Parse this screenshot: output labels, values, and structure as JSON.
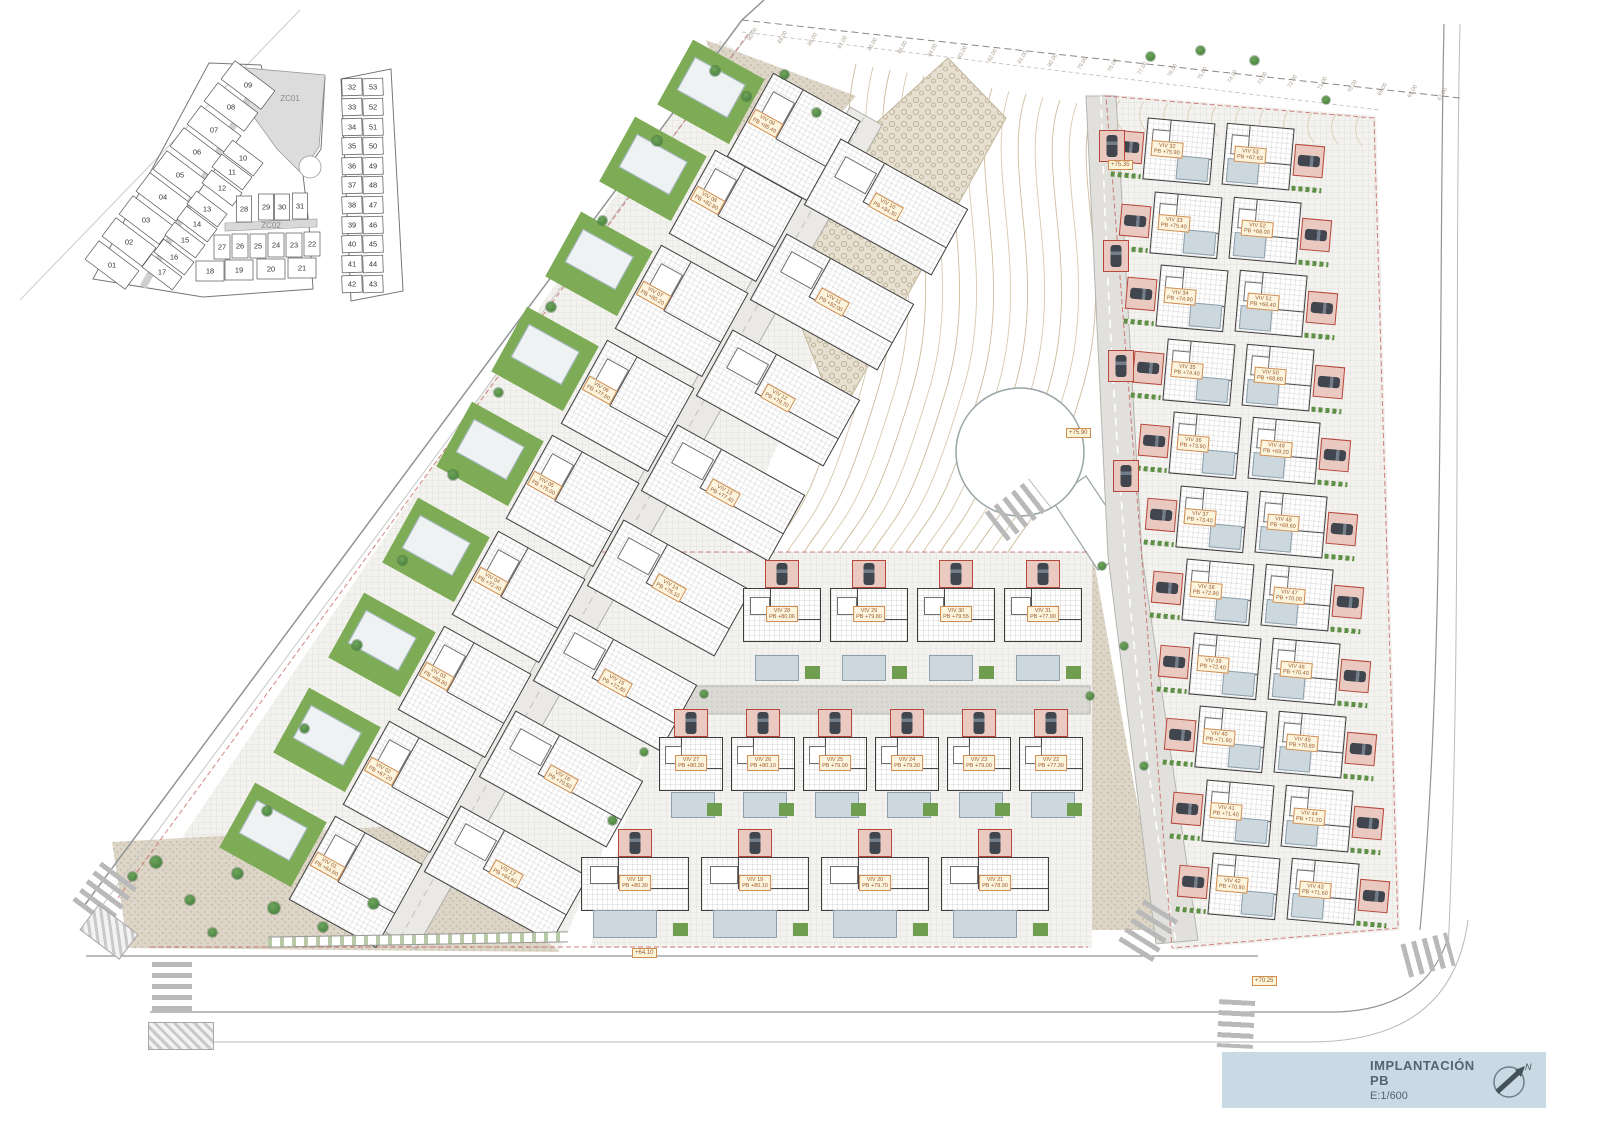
{
  "page": {
    "title_block": {
      "title": "IMPLANTACIÓN PB",
      "scale": "E:1/600",
      "north_label": "N"
    }
  },
  "key_plan": {
    "zones": [
      {
        "label": "ZC01",
        "x": 205,
        "y": 46
      },
      {
        "label": "ZC02",
        "x": 186,
        "y": 173
      }
    ],
    "cells": [
      {
        "n": "01",
        "x": 27,
        "y": 210,
        "w": 50,
        "h": 23,
        "r": 37
      },
      {
        "n": "02",
        "x": 44,
        "y": 187,
        "w": 50,
        "h": 23,
        "r": 37
      },
      {
        "n": "03",
        "x": 61,
        "y": 165,
        "w": 50,
        "h": 23,
        "r": 37
      },
      {
        "n": "04",
        "x": 78,
        "y": 142,
        "w": 50,
        "h": 23,
        "r": 37
      },
      {
        "n": "05",
        "x": 95,
        "y": 120,
        "w": 50,
        "h": 23,
        "r": 37
      },
      {
        "n": "06",
        "x": 112,
        "y": 97,
        "w": 50,
        "h": 23,
        "r": 37
      },
      {
        "n": "07",
        "x": 129,
        "y": 75,
        "w": 50,
        "h": 23,
        "r": 37
      },
      {
        "n": "08",
        "x": 146,
        "y": 52,
        "w": 50,
        "h": 23,
        "r": 37
      },
      {
        "n": "09",
        "x": 163,
        "y": 30,
        "w": 50,
        "h": 23,
        "r": 37
      },
      {
        "n": "10",
        "x": 158,
        "y": 103,
        "w": 38,
        "h": 16,
        "r": 37
      },
      {
        "n": "11",
        "x": 147,
        "y": 117,
        "w": 38,
        "h": 16,
        "r": 37
      },
      {
        "n": "12",
        "x": 137,
        "y": 133,
        "w": 38,
        "h": 16,
        "r": 37
      },
      {
        "n": "13",
        "x": 122,
        "y": 154,
        "w": 38,
        "h": 16,
        "r": 37
      },
      {
        "n": "14",
        "x": 112,
        "y": 169,
        "w": 38,
        "h": 16,
        "r": 37
      },
      {
        "n": "15",
        "x": 100,
        "y": 185,
        "w": 38,
        "h": 16,
        "r": 37
      },
      {
        "n": "16",
        "x": 89,
        "y": 202,
        "w": 38,
        "h": 16,
        "r": 37
      },
      {
        "n": "17",
        "x": 77,
        "y": 217,
        "w": 38,
        "h": 16,
        "r": 37
      },
      {
        "n": "28",
        "x": 159,
        "y": 154,
        "w": 15,
        "h": 26,
        "r": 0
      },
      {
        "n": "29",
        "x": 181,
        "y": 152,
        "w": 15,
        "h": 26,
        "r": 0
      },
      {
        "n": "30",
        "x": 197,
        "y": 152,
        "w": 15,
        "h": 26,
        "r": 0
      },
      {
        "n": "31",
        "x": 215,
        "y": 151,
        "w": 15,
        "h": 26,
        "r": 0
      },
      {
        "n": "27",
        "x": 137,
        "y": 192,
        "w": 16,
        "h": 24,
        "r": 0
      },
      {
        "n": "26",
        "x": 155,
        "y": 191,
        "w": 16,
        "h": 24,
        "r": 0
      },
      {
        "n": "25",
        "x": 173,
        "y": 191,
        "w": 16,
        "h": 24,
        "r": 0
      },
      {
        "n": "24",
        "x": 191,
        "y": 190,
        "w": 16,
        "h": 24,
        "r": 0
      },
      {
        "n": "23",
        "x": 209,
        "y": 190,
        "w": 16,
        "h": 24,
        "r": 0
      },
      {
        "n": "22",
        "x": 227,
        "y": 189,
        "w": 16,
        "h": 24,
        "r": 0
      },
      {
        "n": "18",
        "x": 125,
        "y": 216,
        "w": 28,
        "h": 20,
        "r": 0
      },
      {
        "n": "19",
        "x": 154,
        "y": 215,
        "w": 28,
        "h": 20,
        "r": 0
      },
      {
        "n": "20",
        "x": 186,
        "y": 214,
        "w": 28,
        "h": 20,
        "r": 0
      },
      {
        "n": "21",
        "x": 217,
        "y": 213,
        "w": 28,
        "h": 20,
        "r": 0
      },
      {
        "n": "32",
        "x": 267,
        "y": 32,
        "w": 20,
        "h": 17,
        "r": -2
      },
      {
        "n": "53",
        "x": 288,
        "y": 32,
        "w": 20,
        "h": 17,
        "r": -2
      },
      {
        "n": "33",
        "x": 267,
        "y": 52,
        "w": 20,
        "h": 17,
        "r": -2
      },
      {
        "n": "52",
        "x": 288,
        "y": 52,
        "w": 20,
        "h": 17,
        "r": -2
      },
      {
        "n": "34",
        "x": 267,
        "y": 72,
        "w": 20,
        "h": 17,
        "r": -2
      },
      {
        "n": "51",
        "x": 288,
        "y": 72,
        "w": 20,
        "h": 17,
        "r": -2
      },
      {
        "n": "35",
        "x": 267,
        "y": 91,
        "w": 20,
        "h": 17,
        "r": -2
      },
      {
        "n": "50",
        "x": 288,
        "y": 91,
        "w": 20,
        "h": 17,
        "r": -2
      },
      {
        "n": "36",
        "x": 267,
        "y": 111,
        "w": 20,
        "h": 17,
        "r": -2
      },
      {
        "n": "49",
        "x": 288,
        "y": 111,
        "w": 20,
        "h": 17,
        "r": -2
      },
      {
        "n": "37",
        "x": 267,
        "y": 130,
        "w": 20,
        "h": 17,
        "r": -2
      },
      {
        "n": "48",
        "x": 288,
        "y": 130,
        "w": 20,
        "h": 17,
        "r": -2
      },
      {
        "n": "38",
        "x": 267,
        "y": 150,
        "w": 20,
        "h": 17,
        "r": -2
      },
      {
        "n": "47",
        "x": 288,
        "y": 150,
        "w": 20,
        "h": 17,
        "r": -2
      },
      {
        "n": "39",
        "x": 267,
        "y": 170,
        "w": 20,
        "h": 17,
        "r": -2
      },
      {
        "n": "46",
        "x": 288,
        "y": 170,
        "w": 20,
        "h": 17,
        "r": -2
      },
      {
        "n": "40",
        "x": 267,
        "y": 189,
        "w": 20,
        "h": 17,
        "r": -2
      },
      {
        "n": "45",
        "x": 288,
        "y": 189,
        "w": 20,
        "h": 17,
        "r": -2
      },
      {
        "n": "41",
        "x": 267,
        "y": 209,
        "w": 20,
        "h": 17,
        "r": -2
      },
      {
        "n": "44",
        "x": 288,
        "y": 209,
        "w": 20,
        "h": 17,
        "r": -2
      },
      {
        "n": "42",
        "x": 267,
        "y": 229,
        "w": 20,
        "h": 17,
        "r": -2
      },
      {
        "n": "43",
        "x": 288,
        "y": 229,
        "w": 20,
        "h": 17,
        "r": -2
      }
    ]
  },
  "site": {
    "contour_ticks": [
      {
        "t": "90.00",
        "x": 752,
        "y": 36
      },
      {
        "t": "89.00",
        "x": 782,
        "y": 39
      },
      {
        "t": "88.00",
        "x": 812,
        "y": 41
      },
      {
        "t": "87.00",
        "x": 842,
        "y": 44
      },
      {
        "t": "86.00",
        "x": 872,
        "y": 46
      },
      {
        "t": "85.00",
        "x": 902,
        "y": 49
      },
      {
        "t": "84.00",
        "x": 932,
        "y": 52
      },
      {
        "t": "83.00",
        "x": 962,
        "y": 54
      },
      {
        "t": "82.00",
        "x": 992,
        "y": 57
      },
      {
        "t": "81.00",
        "x": 1022,
        "y": 59
      },
      {
        "t": "80.00",
        "x": 1052,
        "y": 62
      },
      {
        "t": "79.00",
        "x": 1082,
        "y": 65
      },
      {
        "t": "78.00",
        "x": 1112,
        "y": 67
      },
      {
        "t": "77.00",
        "x": 1142,
        "y": 70
      },
      {
        "t": "76.00",
        "x": 1172,
        "y": 72
      },
      {
        "t": "75.00",
        "x": 1202,
        "y": 75
      },
      {
        "t": "74.00",
        "x": 1232,
        "y": 78
      },
      {
        "t": "73.00",
        "x": 1262,
        "y": 80
      },
      {
        "t": "72.00",
        "x": 1292,
        "y": 83
      },
      {
        "t": "71.00",
        "x": 1322,
        "y": 85
      },
      {
        "t": "70.00",
        "x": 1352,
        "y": 88
      },
      {
        "t": "69.00",
        "x": 1382,
        "y": 91
      },
      {
        "t": "68.00",
        "x": 1412,
        "y": 93
      },
      {
        "t": "67.00",
        "x": 1442,
        "y": 96
      }
    ],
    "road_markers": [
      {
        "t": "+75.35",
        "x": 1108,
        "y": 160
      },
      {
        "t": "+75.90",
        "x": 1066,
        "y": 428
      },
      {
        "t": "+64.10",
        "x": 632,
        "y": 948
      },
      {
        "t": "+70.25",
        "x": 1252,
        "y": 976
      }
    ],
    "villas": [
      {
        "n": "VIV 01",
        "pb": "PB +64.60",
        "x": 318,
        "y": 861,
        "t": "west"
      },
      {
        "n": "VIV 02",
        "pb": "PB +67.20",
        "x": 372,
        "y": 766,
        "t": "west"
      },
      {
        "n": "VIV 03",
        "pb": "PB +69.80",
        "x": 427,
        "y": 671,
        "t": "west"
      },
      {
        "n": "VIV 04",
        "pb": "PB +72.40",
        "x": 481,
        "y": 576,
        "t": "west"
      },
      {
        "n": "VIV 05",
        "pb": "PB +75.00",
        "x": 535,
        "y": 480,
        "t": "west"
      },
      {
        "n": "VIV 06",
        "pb": "PB +77.60",
        "x": 590,
        "y": 385,
        "t": "west"
      },
      {
        "n": "VIV 07",
        "pb": "PB +80.20",
        "x": 644,
        "y": 290,
        "t": "west"
      },
      {
        "n": "VIV 08",
        "pb": "PB +82.80",
        "x": 698,
        "y": 195,
        "t": "west"
      },
      {
        "n": "VIV 09",
        "pb": "PB +85.40",
        "x": 756,
        "y": 118,
        "t": "west"
      },
      {
        "n": "VIV 10",
        "pb": "PB +84.30",
        "x": 886,
        "y": 207,
        "t": "east"
      },
      {
        "n": "VIV 11",
        "pb": "PB +82.00",
        "x": 832,
        "y": 302,
        "t": "east"
      },
      {
        "n": "VIV 12",
        "pb": "PB +79.70",
        "x": 778,
        "y": 398,
        "t": "east"
      },
      {
        "n": "VIV 13",
        "pb": "PB +77.40",
        "x": 723,
        "y": 493,
        "t": "east"
      },
      {
        "n": "VIV 14",
        "pb": "PB +75.10",
        "x": 669,
        "y": 588,
        "t": "east"
      },
      {
        "n": "VIV 15",
        "pb": "PB +72.80",
        "x": 615,
        "y": 683,
        "t": "east"
      },
      {
        "n": "VIV 16",
        "pb": "PB +70.50",
        "x": 561,
        "y": 779,
        "t": "east"
      },
      {
        "n": "VIV 17",
        "pb": "PB +64.60",
        "x": 506,
        "y": 874,
        "t": "east"
      },
      {
        "n": "VIV 28",
        "pb": "PB +80.06",
        "x": 782,
        "y": 622,
        "t": "row"
      },
      {
        "n": "VIV 29",
        "pb": "PB +79.80",
        "x": 869,
        "y": 622,
        "t": "row"
      },
      {
        "n": "VIV 30",
        "pb": "PB +79.55",
        "x": 956,
        "y": 622,
        "t": "row"
      },
      {
        "n": "VIV 31",
        "pb": "PB +77.90",
        "x": 1043,
        "y": 622,
        "t": "row"
      },
      {
        "n": "VIV 27",
        "pb": "PB +80.30",
        "x": 691,
        "y": 765,
        "t": "row2"
      },
      {
        "n": "VIV 26",
        "pb": "PB +80.10",
        "x": 763,
        "y": 765,
        "t": "row2"
      },
      {
        "n": "VIV 25",
        "pb": "PB +79.90",
        "x": 835,
        "y": 765,
        "t": "row2"
      },
      {
        "n": "VIV 24",
        "pb": "PB +79.30",
        "x": 907,
        "y": 765,
        "t": "row2"
      },
      {
        "n": "VIV 23",
        "pb": "PB +79.00",
        "x": 979,
        "y": 765,
        "t": "row2"
      },
      {
        "n": "VIV 22",
        "pb": "PB +77.30",
        "x": 1051,
        "y": 765,
        "t": "row2"
      },
      {
        "n": "VIV 18",
        "pb": "PB +80.30",
        "x": 635,
        "y": 885,
        "t": "row3"
      },
      {
        "n": "VIV 19",
        "pb": "PB +80.10",
        "x": 755,
        "y": 885,
        "t": "row3"
      },
      {
        "n": "VIV 20",
        "pb": "PB +79.70",
        "x": 875,
        "y": 885,
        "t": "row3"
      },
      {
        "n": "VIV 21",
        "pb": "PB +78.90",
        "x": 995,
        "y": 885,
        "t": "row3"
      },
      {
        "n": "VIV 32",
        "pb": "PB +75.90",
        "x": 1163,
        "y": 150,
        "t": "grid"
      },
      {
        "n": "VIV 53",
        "pb": "PB +67.63",
        "x": 1274,
        "y": 158,
        "t": "gridR"
      },
      {
        "n": "VIV 33",
        "pb": "PB +75.40",
        "x": 1170,
        "y": 224,
        "t": "grid"
      },
      {
        "n": "VIV 52",
        "pb": "PB +68.00",
        "x": 1281,
        "y": 232,
        "t": "gridR"
      },
      {
        "n": "VIV 34",
        "pb": "PB +74.90",
        "x": 1176,
        "y": 297,
        "t": "grid"
      },
      {
        "n": "VIV 51",
        "pb": "PB +68.40",
        "x": 1287,
        "y": 305,
        "t": "gridR"
      },
      {
        "n": "VIV 35",
        "pb": "PB +74.40",
        "x": 1183,
        "y": 371,
        "t": "grid"
      },
      {
        "n": "VIV 50",
        "pb": "PB +68.80",
        "x": 1294,
        "y": 379,
        "t": "gridR"
      },
      {
        "n": "VIV 36",
        "pb": "PB +73.90",
        "x": 1189,
        "y": 444,
        "t": "grid"
      },
      {
        "n": "VIV 49",
        "pb": "PB +69.20",
        "x": 1300,
        "y": 452,
        "t": "gridR"
      },
      {
        "n": "VIV 37",
        "pb": "PB +73.40",
        "x": 1196,
        "y": 518,
        "t": "grid"
      },
      {
        "n": "VIV 48",
        "pb": "PB +69.60",
        "x": 1307,
        "y": 526,
        "t": "gridR"
      },
      {
        "n": "VIV 38",
        "pb": "PB +72.90",
        "x": 1202,
        "y": 591,
        "t": "grid"
      },
      {
        "n": "VIV 47",
        "pb": "PB +70.00",
        "x": 1313,
        "y": 599,
        "t": "gridR"
      },
      {
        "n": "VIV 39",
        "pb": "PB +72.40",
        "x": 1209,
        "y": 665,
        "t": "grid"
      },
      {
        "n": "VIV 46",
        "pb": "PB +70.40",
        "x": 1320,
        "y": 673,
        "t": "gridR"
      },
      {
        "n": "VIV 40",
        "pb": "PB +71.90",
        "x": 1215,
        "y": 738,
        "t": "grid"
      },
      {
        "n": "VIV 45",
        "pb": "PB +70.80",
        "x": 1326,
        "y": 746,
        "t": "gridR"
      },
      {
        "n": "VIV 41",
        "pb": "PB +71.40",
        "x": 1222,
        "y": 812,
        "t": "grid"
      },
      {
        "n": "VIV 44",
        "pb": "PB +71.20",
        "x": 1333,
        "y": 820,
        "t": "gridR"
      },
      {
        "n": "VIV 42",
        "pb": "PB +70.90",
        "x": 1228,
        "y": 885,
        "t": "grid"
      },
      {
        "n": "VIV 43",
        "pb": "PB +71.60",
        "x": 1339,
        "y": 893,
        "t": "gridR"
      }
    ]
  }
}
